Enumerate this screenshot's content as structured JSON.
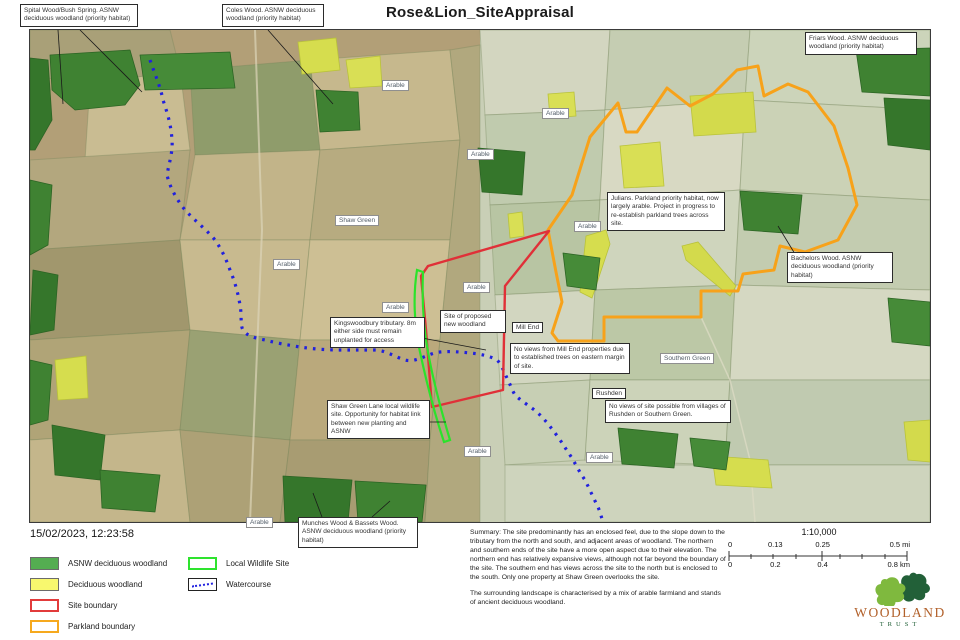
{
  "title": "Rose&Lion_SiteAppraisal",
  "timestamp": "15/02/2023, 12:23:58",
  "map": {
    "area_label": "Arable",
    "place_labels": {
      "shaw_green": "Shaw Green",
      "southern_green": "Southern Green",
      "mill_end": "Mill End",
      "rushden": "Rushden"
    },
    "callouts": {
      "spital": "Spital Wood/Bush Spring. ASNW deciduous woodland (priority habitat)",
      "coles": "Coles Wood. ASNW deciduous woodland (priority habitat)",
      "friars": "Friars Wood. ASNW deciduous woodland (priority habitat)",
      "julians": "Julians. Parkland priority habitat, now largely arable. Project in progress to re-establish parkland trees across site.",
      "bachelors": "Bachelors Wood. ASNW deciduous woodland (priority habitat)",
      "kingswoodbury": "Kingswoodbury tributary. 8m either side must remain unplanted for access",
      "proposed_site": "Site of proposed new woodland",
      "mill_end_note": "No views from Mill End properties due to established trees on eastern margin of site.",
      "rushden_note": "No views of site possible from villages of Rushden or Southern Green.",
      "shaw_green_lane": "Shaw Green Lane local wildlife site. Opportunity for habitat link between new planting and ASNW",
      "munches": "Munches Wood & Bassets Wood. ASNW deciduous woodland (priority habitat)"
    }
  },
  "legend": {
    "items": [
      {
        "label": "ASNW deciduous woodland",
        "color": "#54ad51",
        "style": "fill"
      },
      {
        "label": "Deciduous woodland",
        "color": "#f8f86e",
        "style": "fill"
      },
      {
        "label": "Site boundary",
        "color": "#e23b3b",
        "style": "outline"
      },
      {
        "label": "Parkland boundary",
        "color": "#f6a91e",
        "style": "outline"
      },
      {
        "label": "Local Wildlife Site",
        "color": "#2ee32e",
        "style": "outline"
      },
      {
        "label": "Watercourse",
        "color": "#2222e0",
        "style": "dotted-line"
      }
    ]
  },
  "summary": {
    "para1": "Summary: The site predominantly has an enclosed feel, due to the slope down to the tributary from the north and south, and adjacent areas of woodland. The northern and southern ends of the site have a more open aspect due to their elevation. The northern end has relatively expansive views, although not far beyond the boundary of the site. The southern end has views across the site to the north but is enclosed to the south. Only one property at Shaw Green overlooks the site.",
    "para2": "The surrounding landscape is characterised by a mix of arable farmland and stands of ancient deciduous woodland."
  },
  "scalebar": {
    "ratio": "1:10,000",
    "mi": [
      "0",
      "0.13",
      "0.25",
      "0.5 mi"
    ],
    "km": [
      "0",
      "0.2",
      "0.4",
      "0.8 km"
    ]
  },
  "logo": {
    "name": "WOODLAND",
    "subname": "TRUST"
  }
}
